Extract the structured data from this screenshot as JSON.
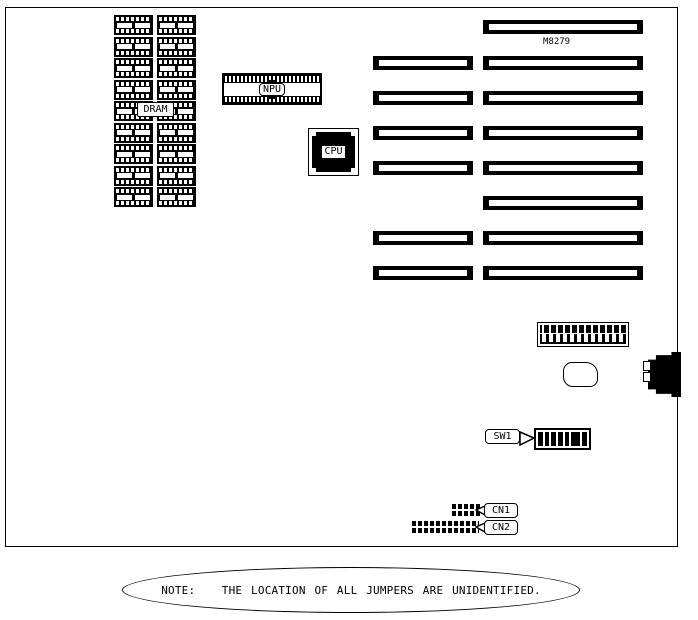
{
  "colors": {
    "ink": "#000000",
    "paper": "#ffffff"
  },
  "chips": {
    "dram": {
      "label": "DRAM",
      "columns": 2,
      "rows": 9
    },
    "npu": {
      "label": "NPU"
    },
    "cpu": {
      "label": "CPU"
    },
    "m8279": {
      "label": "M8279"
    }
  },
  "expansion_slots": {
    "right": {
      "count": 8
    },
    "left": {
      "count": 6,
      "rows_present": [
        2,
        3,
        4,
        5,
        7,
        8
      ]
    }
  },
  "connectors": {
    "power": {
      "pins": 12
    },
    "keyboard": {
      "pins": 2
    },
    "sw1": {
      "label": "SW1",
      "positions": 8,
      "segments": [
        1,
        1,
        1,
        1,
        1,
        2,
        1
      ]
    },
    "cn1": {
      "label": "CN1",
      "pins": 4
    },
    "cn2": {
      "label": "CN2",
      "pins": 11
    }
  },
  "note": {
    "text": "NOTE:   THE LOCATION OF ALL JUMPERS ARE UNIDENTIFIED."
  }
}
